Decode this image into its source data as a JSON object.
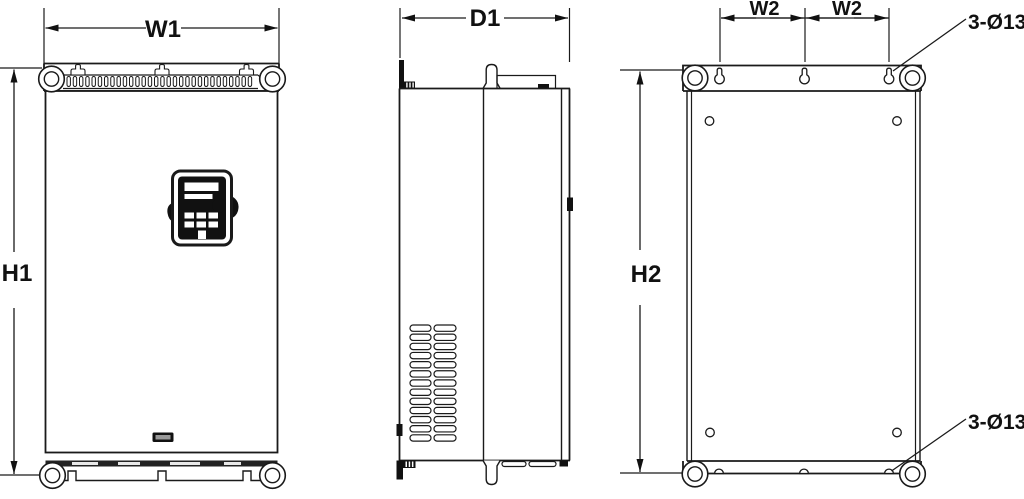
{
  "figure": {
    "kind": "technical-dimension-drawing",
    "labels": {
      "front_width": "W1",
      "front_height": "H1",
      "side_depth": "D1",
      "mount_width_left": "W2",
      "mount_width_right": "W2",
      "mount_height": "H2",
      "hole_note_top": "3-Ø13",
      "hole_note_bottom": "3-Ø13"
    },
    "colors": {
      "line": "#1a1a1a",
      "fill_dark": "#111111",
      "background": "#ffffff"
    }
  }
}
